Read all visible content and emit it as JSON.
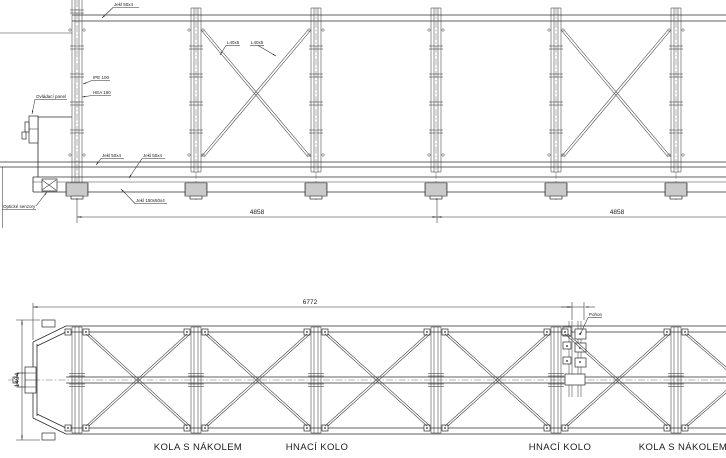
{
  "drawing": {
    "elevation": {
      "labels": {
        "top_chord": "Jekl 50x4",
        "column_profile_1": "IPE 100",
        "column_profile_2": "HEA 160",
        "control_panel": "Ovládací panel",
        "optical_sensors": "Optické senzory",
        "diagonal_left": "L40x5",
        "diagonal_right": "L40x5",
        "bottom_chord": "Jekl 50x4",
        "bottom_member": "Jekl 50x4",
        "base_beam": "Jekl 150x50x4"
      },
      "dimensions": {
        "span_left": "4858",
        "span_right": "4858"
      }
    },
    "plan": {
      "labels": {
        "drive": "Pohon"
      },
      "dimensions": {
        "length": "6772",
        "width": "1494"
      },
      "wheel_labels": [
        "KOLA S NÁKOLEM",
        "HNACÍ KOLO",
        "HNACÍ KOLO",
        "KOLA S NÁKOLEM"
      ]
    }
  }
}
